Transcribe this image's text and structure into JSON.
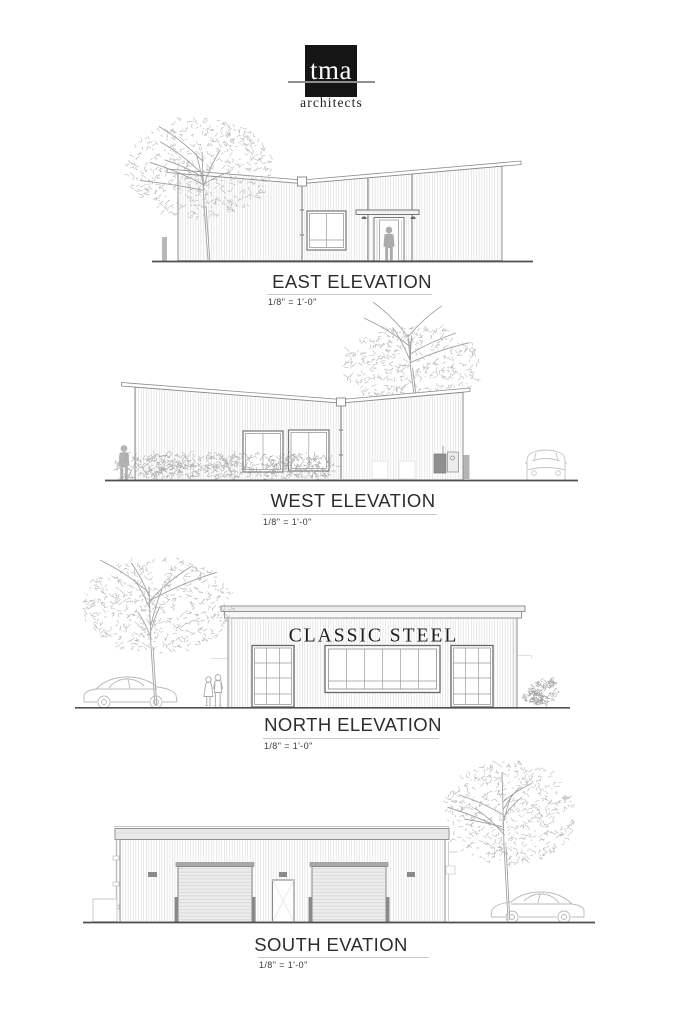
{
  "sheet": {
    "background": "#ffffff"
  },
  "logo": {
    "monogram": "tma",
    "subtitle": "architects",
    "square_color": "#151515",
    "rule_color": "#8f8f8f"
  },
  "elevations": [
    {
      "id": "east",
      "label": "EAST ELEVATION",
      "scale": "1/8\" = 1'-0\""
    },
    {
      "id": "west",
      "label": "WEST ELEVATION",
      "scale": "1/8\" = 1'-0\""
    },
    {
      "id": "north",
      "label": "NORTH ELEVATION",
      "scale": "1/8\" = 1'-0\"",
      "signage": "CLASSIC STEEL"
    },
    {
      "id": "south",
      "label": "SOUTH EVATION",
      "scale": "1/8\" = 1'-0\""
    }
  ],
  "colors": {
    "ground_line": "#4f4f4f",
    "wall_outline": "#8c8c8c",
    "siding_line": "#dadada",
    "foliage": "#b4b4b4",
    "sign_text": "#1d1d1d"
  }
}
